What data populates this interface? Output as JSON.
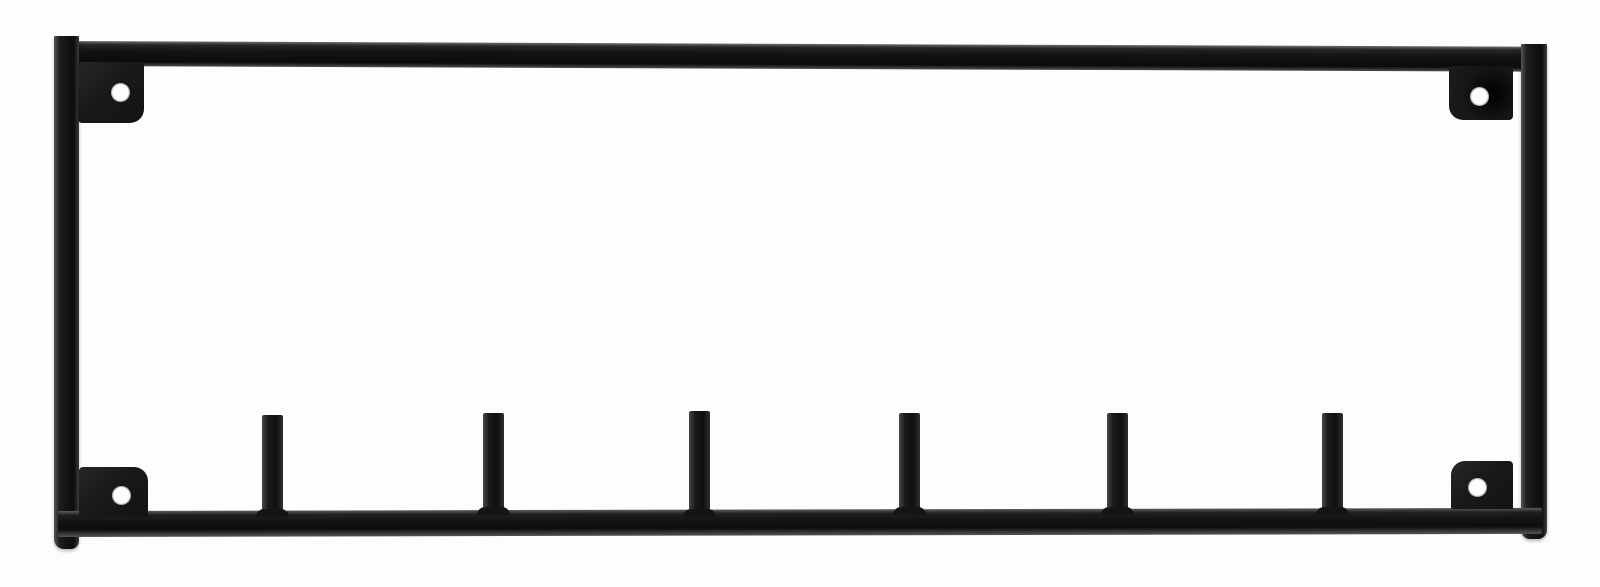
{
  "product": {
    "description": "Black metal wall-mounted hook rack: rectangular open frame with four corner mounting plates (each with a round screw hole) and six straight hooks rising from the bottom rail, photographed on a plain white background",
    "hook_count": 6,
    "mounting_plate_count": 4,
    "screw_hole_count": 4,
    "parts": {
      "top_bar": "frame top bar",
      "left_bar": "frame left upright",
      "right_bar": "frame right upright",
      "bottom_rail": "frame bottom rail with hooks",
      "mounting_plate": "corner mounting plate with screw hole",
      "hook": "straight peg hook"
    },
    "colors": {
      "metal": "#141414",
      "metal_highlight": "#5c5c5c",
      "background": "#fdfdfd",
      "screw_hole": "#fdfdfd"
    }
  }
}
